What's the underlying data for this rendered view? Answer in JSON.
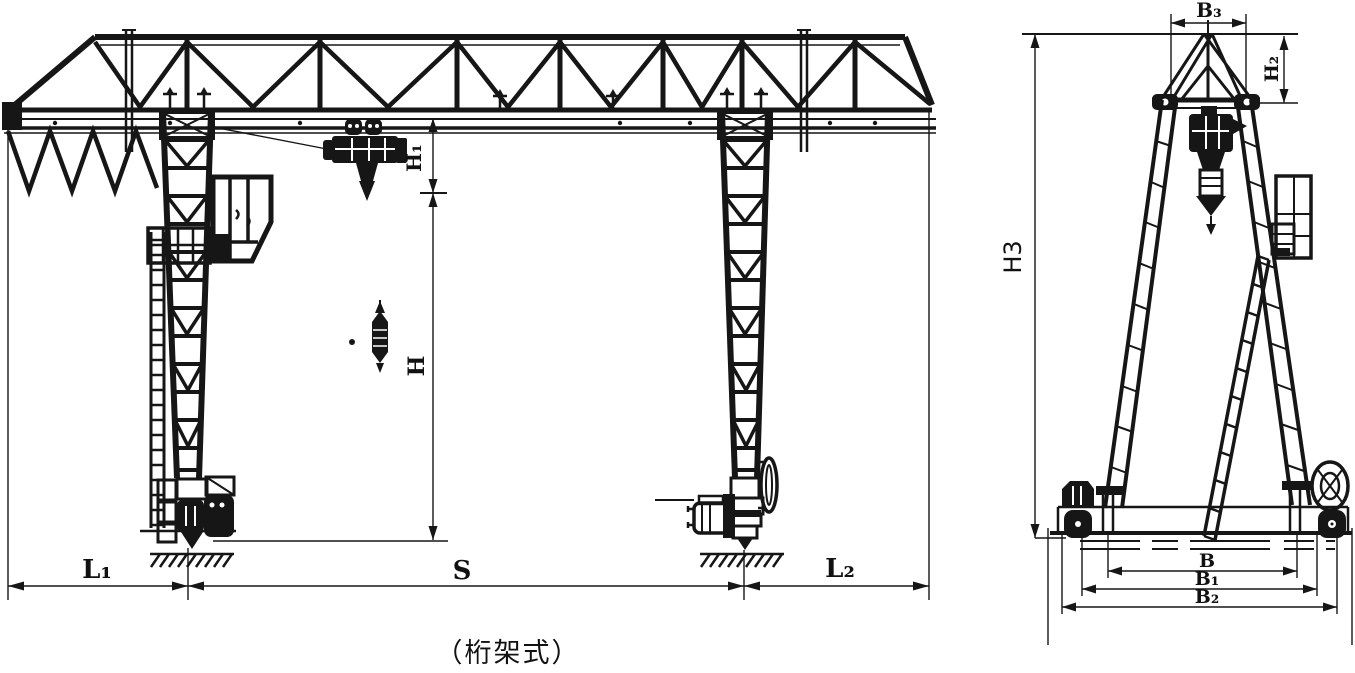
{
  "caption": "（桁架式）",
  "front_view": {
    "dims": {
      "l1": "L₁",
      "s": "S",
      "l2": "L₂",
      "h": "H",
      "h1": "H₁"
    }
  },
  "side_view": {
    "dims": {
      "b3": "B₃",
      "h2": "H₂",
      "h3": "H3",
      "b": "B",
      "b1": "B₁",
      "b2": "B₂"
    }
  },
  "colors": {
    "ink": "#161616",
    "paper": "#ffffff"
  }
}
